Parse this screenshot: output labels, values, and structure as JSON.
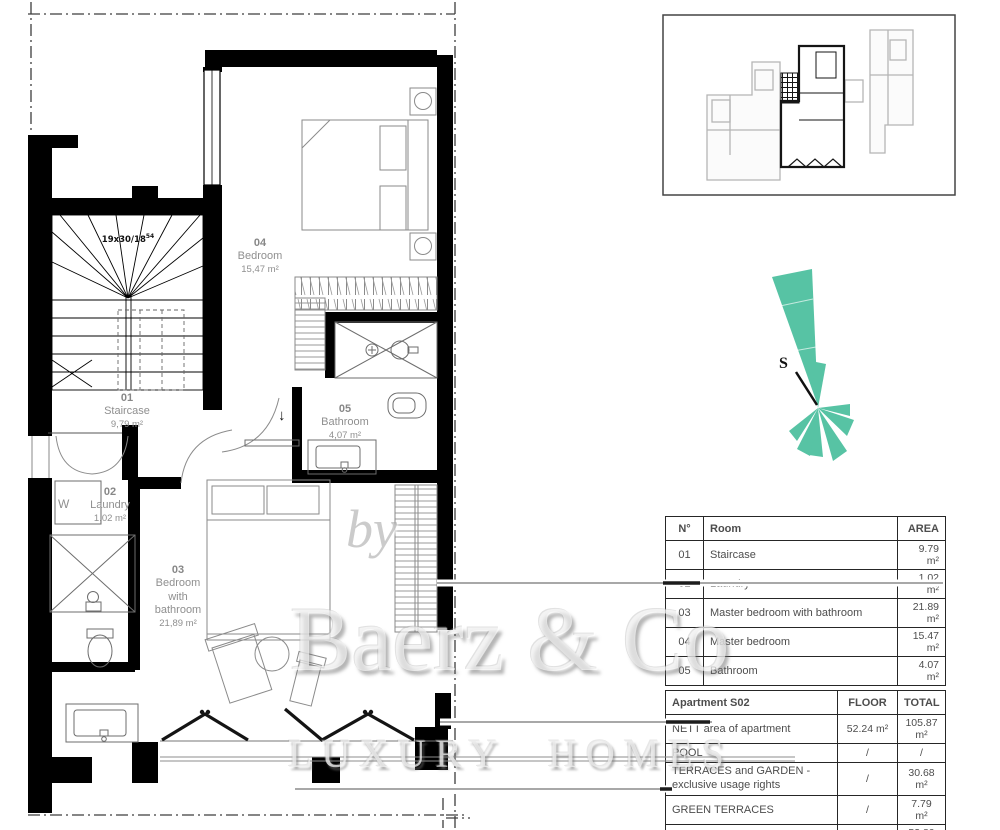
{
  "plan": {
    "stair_note": "19x30/18",
    "stair_note_sup": "54",
    "washer_label": "W",
    "entry_arrow": "↓",
    "rooms": [
      {
        "number": "01",
        "name": "Staircase",
        "area": "9,79 m²"
      },
      {
        "number": "02",
        "name": "Laundry",
        "area": "1,02 m²"
      },
      {
        "number": "03",
        "name": "Bedroom with bathroom",
        "area": "21,89 m²"
      },
      {
        "number": "04",
        "name": "Bedroom",
        "area": "15,47 m²"
      },
      {
        "number": "05",
        "name": "Bathroom",
        "area": "4,07 m²"
      }
    ]
  },
  "compass": {
    "label": "S",
    "color": "#57c3a4"
  },
  "room_table": {
    "headers": {
      "no": "N°",
      "room": "Room",
      "area": "AREA"
    },
    "rows": [
      {
        "no": "01",
        "room": "Staircase",
        "area": "9.79 m²"
      },
      {
        "no": "02",
        "room": "Laundry",
        "area": "1.02 m²"
      },
      {
        "no": "03",
        "room": "Master bedroom with bathroom",
        "area": "21.89 m²"
      },
      {
        "no": "04",
        "room": "Master bedroom",
        "area": "15.47 m²"
      },
      {
        "no": "05",
        "room": "Bathroom",
        "area": "4.07 m²"
      }
    ]
  },
  "apartment_table": {
    "title": "Apartment S02",
    "headers": {
      "floor": "FLOOR",
      "total": "TOTAL"
    },
    "rows": [
      {
        "label": "NETT area of apartment",
        "floor": "52.24 m²",
        "total": "105.87 m²"
      },
      {
        "label": "POOL",
        "floor": "/",
        "total": "/"
      },
      {
        "label": "TERRACES and GARDEN - exclusive usage rights",
        "floor": "/",
        "total": "30.68 m²"
      },
      {
        "label": "GREEN TERRACES",
        "floor": "/",
        "total": "7.79 m²"
      },
      {
        "label": "GARAGE - basement",
        "floor": "/",
        "total": "53.80 m²"
      }
    ]
  },
  "watermark": {
    "by": "by",
    "brand": "Baerz & Co",
    "tagline": "LUXURY HOMES"
  }
}
